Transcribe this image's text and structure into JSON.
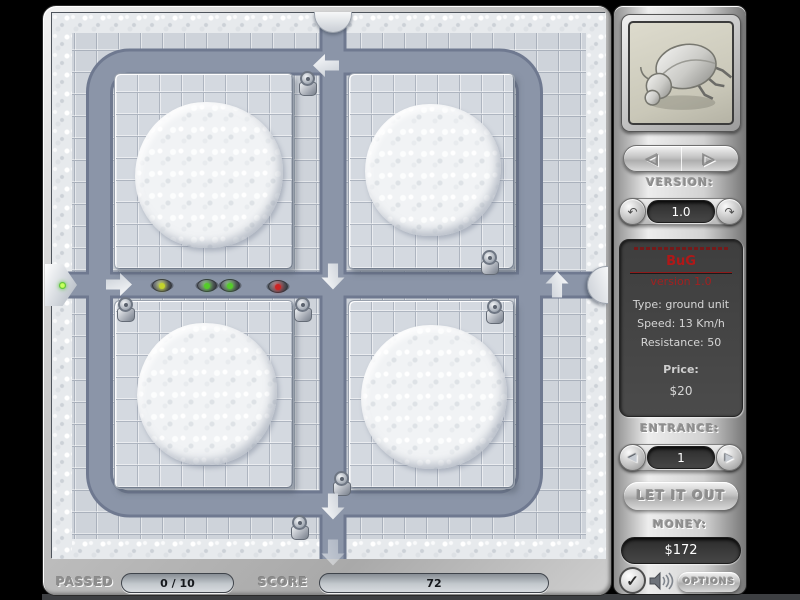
{
  "sidebar": {
    "preview_unit": "bug-beetle",
    "version": {
      "label": "VERSION:",
      "value": "1.0"
    },
    "info": {
      "title": "BuG",
      "subtitle": "version 1.0",
      "type": "Type: ground unit",
      "speed": "Speed: 13 Km/h",
      "resistance": "Resistance: 50",
      "price_label": "Price:",
      "price_value": "$20",
      "title_color": "#b01818"
    },
    "entrance": {
      "label": "ENTRANCE:",
      "value": "1"
    },
    "release_button": "LET IT OUT",
    "money": {
      "label": "MONEY:",
      "value": "$172"
    },
    "options_button": "OPTIONS"
  },
  "statusbar": {
    "passed_label": "PASSED",
    "passed_value": "0 / 10",
    "score_label": "SCORE",
    "score_value": "72"
  },
  "icons": {
    "nav_prev": "◁",
    "nav_next": "▷",
    "version_dec": "↶",
    "version_inc": "↷",
    "entrance_prev": "◀",
    "entrance_next": "▶",
    "check": "✓"
  },
  "colors": {
    "path": "#8b95a8",
    "path_edge": "#6f7990",
    "tile": "#ced3da",
    "info_panel": "#474747",
    "accent_red": "#b01818"
  },
  "board": {
    "turrets": [
      {
        "x": 246,
        "y": 58
      },
      {
        "x": 428,
        "y": 237
      },
      {
        "x": 64,
        "y": 284
      },
      {
        "x": 241,
        "y": 284
      },
      {
        "x": 433,
        "y": 286
      },
      {
        "x": 280,
        "y": 458
      },
      {
        "x": 238,
        "y": 502
      }
    ],
    "bugs": [
      {
        "x": 100,
        "y": 266,
        "color": "#c3d32c"
      },
      {
        "x": 145,
        "y": 266,
        "color": "#55cc2a"
      },
      {
        "x": 168,
        "y": 266,
        "color": "#55cc2a"
      },
      {
        "x": 216,
        "y": 267,
        "color": "#cc2424"
      }
    ],
    "arrows": [
      {
        "x": 54,
        "y": 260,
        "dir": "right"
      },
      {
        "x": 261,
        "y": 41,
        "dir": "left"
      },
      {
        "x": 268,
        "y": 252,
        "dir": "down"
      },
      {
        "x": 492,
        "y": 260,
        "dir": "up"
      },
      {
        "x": 268,
        "y": 482,
        "dir": "down"
      },
      {
        "x": 268,
        "y": 528,
        "dir": "down",
        "faint": true
      }
    ]
  }
}
